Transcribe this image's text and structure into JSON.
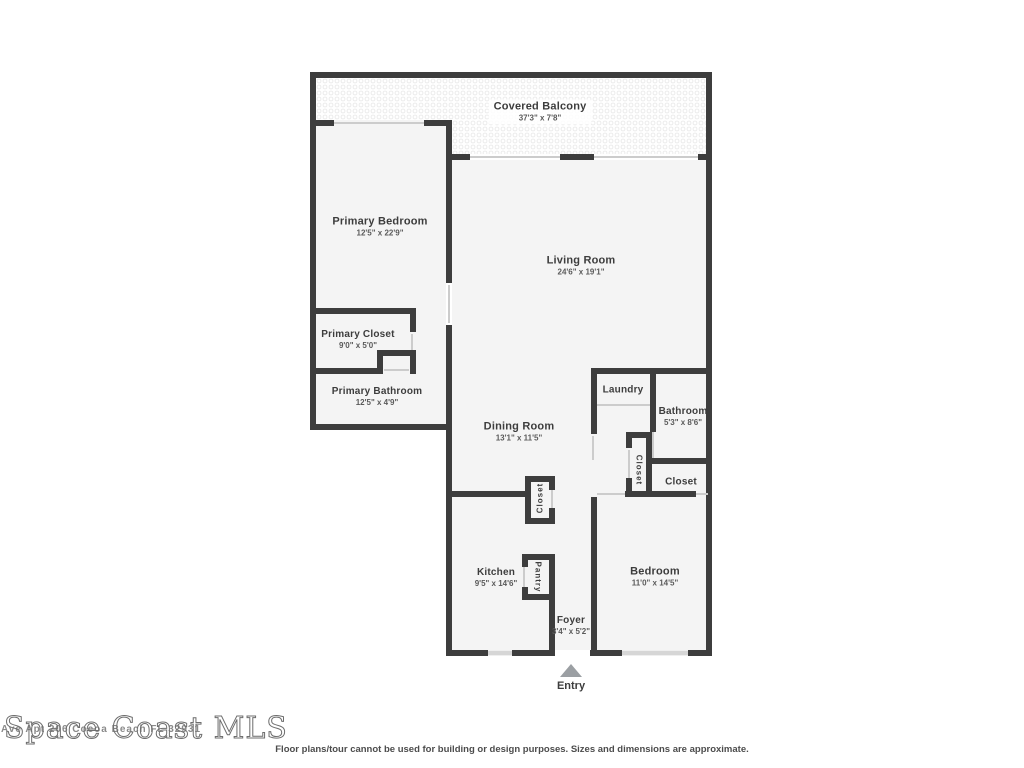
{
  "plan": {
    "rooms": {
      "covered_balcony": {
        "name": "Covered Balcony",
        "dims": "37'3\" x 7'8\""
      },
      "primary_bedroom": {
        "name": "Primary Bedroom",
        "dims": "12'5\" x 22'9\""
      },
      "living_room": {
        "name": "Living Room",
        "dims": "24'6\" x 19'1\""
      },
      "primary_closet": {
        "name": "Primary Closet",
        "dims": "9'0\" x 5'0\""
      },
      "primary_bathroom": {
        "name": "Primary Bathroom",
        "dims": "12'5\" x 4'9\""
      },
      "dining_room": {
        "name": "Dining Room",
        "dims": "13'1\" x 11'5\""
      },
      "laundry": {
        "name": "Laundry"
      },
      "bathroom": {
        "name": "Bathroom",
        "dims": "5'3\" x 8'6\""
      },
      "closet_hall": {
        "name": "Closet"
      },
      "closet_bedroom": {
        "name": "Closet"
      },
      "closet_dining": {
        "name": "Closet"
      },
      "kitchen": {
        "name": "Kitchen",
        "dims": "9'5\" x 14'6\""
      },
      "pantry": {
        "name": "Pantry"
      },
      "bedroom": {
        "name": "Bedroom",
        "dims": "11'0\" x 14'5\""
      },
      "foyer": {
        "name": "Foyer",
        "dims": "3'4\" x 5'2\""
      }
    },
    "entry_label": "Entry"
  },
  "watermark": {
    "title": "Space Coast MLS",
    "address": "Ave Apt 206 Cocoa Beach FL 32931"
  },
  "disclaimer": "Floor plans/tour cannot be used for building or design purposes. Sizes and dimensions are approximate."
}
